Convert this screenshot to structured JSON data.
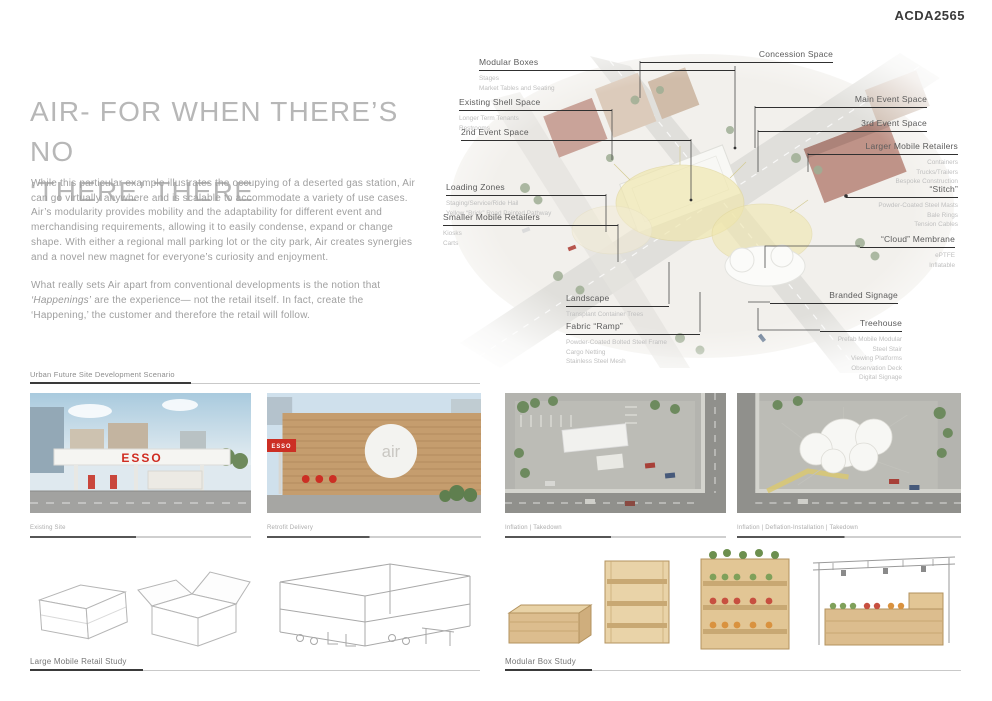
{
  "header": {
    "project_code": "ACDA2565"
  },
  "intro": {
    "title_line1": "AIR- FOR WHEN THERE’S NO",
    "title_line2": "‘THERE’ THERE",
    "paragraph1": "While this particular example illustrates the occupying of a deserted gas station, Air can go virtually anywhere and is scalable to accommodate a variety of use cases. Air’s modularity provides mobility and the adaptability for different event and merchandising requirements, allowing it to easily condense, expand or change shape. With either a regional mall parking lot or the city park, Air creates synergies and a novel new magnet for everyone’s curiosity and enjoyment.",
    "paragraph2_prefix": "What really sets Air apart from conventional developments is the notion that",
    "paragraph2_italic": "‘Happenings’",
    "paragraph2_rest": "are the experience— not the retail itself. In fact, create the ‘Happening,’ the customer and therefore the retail will follow."
  },
  "diagram": {
    "annotations": {
      "left": [
        {
          "title": "Modular Boxes",
          "subs": [
            "Stages",
            "Market Tables and Seating"
          ]
        },
        {
          "title": "Existing Shell Space",
          "subs": [
            "Longer Term Tenants",
            "Restrooms"
          ]
        },
        {
          "title": "2nd Event Space",
          "subs": []
        },
        {
          "title": "Loading Zones",
          "subs": [
            "Staging/Service/Ride Hail",
            "Yellow “Brick” Road Painted Pathway"
          ]
        },
        {
          "title": "Smaller Mobile Retailers",
          "subs": [
            "Kiosks",
            "Carts"
          ]
        },
        {
          "title": "Landscape",
          "subs": [
            "Transplant Container Trees"
          ]
        },
        {
          "title": "Fabric “Ramp”",
          "subs": [
            "Powder-Coated Bolted Steel Frame",
            "Cargo Netting",
            "Stainless Steel Mesh"
          ]
        }
      ],
      "right": [
        {
          "title": "Concession Space",
          "subs": []
        },
        {
          "title": "Main Event Space",
          "subs": []
        },
        {
          "title": "3rd Event Space",
          "subs": []
        },
        {
          "title": "Larger Mobile Retailers",
          "subs": [
            "Containers",
            "Trucks/Trailers",
            "Bespoke Construction"
          ]
        },
        {
          "title": "“Stitch”",
          "subs": [
            "Powder-Coated Steel Masts",
            "Bale Rings",
            "Tension Cables"
          ]
        },
        {
          "title": "“Cloud” Membrane",
          "subs": [
            "ePTFE",
            "Inflatable"
          ]
        },
        {
          "title": "Branded Signage",
          "subs": []
        },
        {
          "title": "Treehouse",
          "subs": [
            "Prefab Mobile Modular",
            "Steel Stair",
            "Viewing Platforms",
            "Observation Deck",
            "Digital Signage"
          ]
        }
      ]
    }
  },
  "scenario": {
    "label": "Urban Future Site Development Scenario",
    "photos": [
      {
        "caption": "Existing Site",
        "sign": "ESSO"
      },
      {
        "caption": "Retrofit Delivery",
        "logo": "air",
        "awning_sign": "ESSO"
      },
      {
        "caption": "Inflation | Takedown"
      },
      {
        "caption": "Inflation | Deflation-Installation | Takedown"
      }
    ]
  },
  "studies": {
    "large_mobile_retail": "Large Mobile Retail Study",
    "modular_box": "Modular Box Study"
  },
  "colors": {
    "accent_red": "#cc2f24",
    "wood": "#c59d6e",
    "canopy_yellow": "#efe5a5",
    "body_text": "#9f9f9f"
  }
}
